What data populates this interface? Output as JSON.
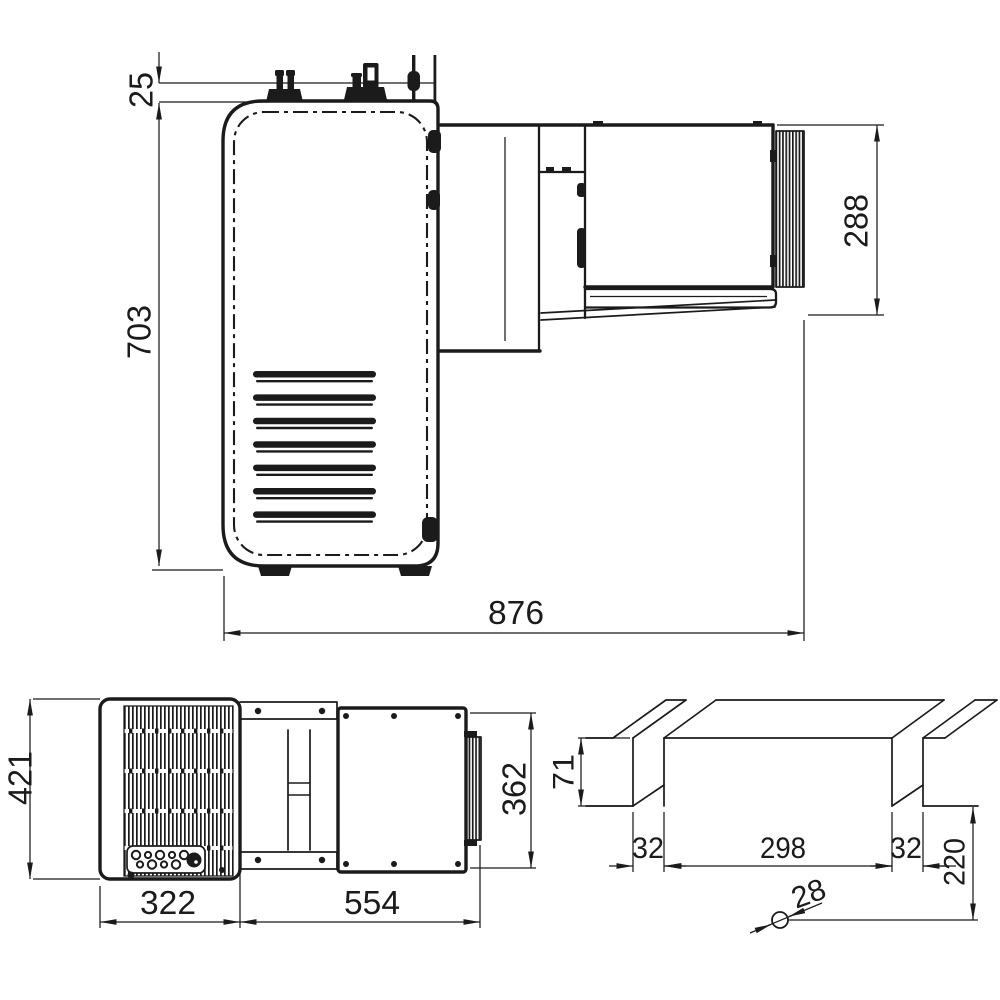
{
  "drawing": {
    "background": "#ffffff",
    "line_color": "#1b1b1b",
    "views": {
      "side": {
        "name": "side-view",
        "dims": {
          "d25": "25",
          "d703": "703",
          "d288": "288",
          "d876": "876"
        }
      },
      "rear": {
        "name": "rear-view",
        "dims": {
          "d421": "421",
          "d322": "322",
          "d554": "554",
          "d362": "362"
        }
      },
      "cutout": {
        "name": "wall-cutout-view",
        "dims": {
          "d71": "71",
          "d32_left": "32",
          "d298": "298",
          "d32_right": "32",
          "d220": "220",
          "d28": "28"
        }
      }
    }
  }
}
